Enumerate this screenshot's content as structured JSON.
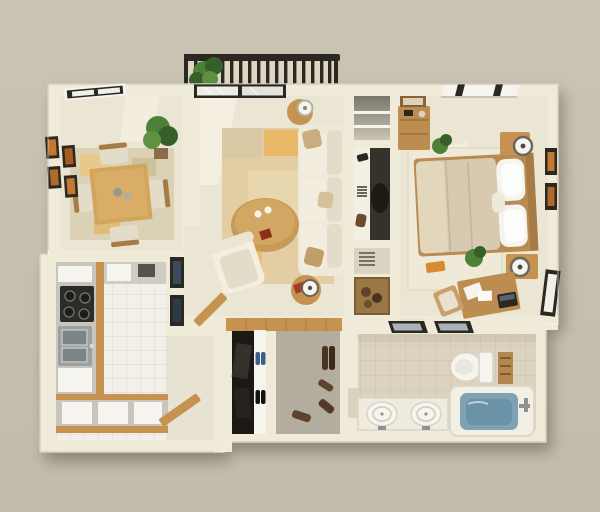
{
  "palette": {
    "bg": "#cbc4b4",
    "bgBottom": "#c2bbaa",
    "wall": "#f0ead8",
    "wallShade": "#dcd6c2",
    "wallEdge": "#b9b3a0",
    "carpet": "#ebe5d4",
    "carpetLight": "#f6f1e2",
    "wood": "#c5924f",
    "woodDark": "#a87a45",
    "woodLight": "#d2a55c",
    "dark": "#2b2723",
    "white": "#f6f4ee",
    "sofa": "#efe9da",
    "cushion": "#e3dcc9",
    "pillowTan": "#c9ad7e",
    "rugTan": "#e3cda2",
    "rugOrange": "#e9b869",
    "rugDining": "#dbd1b4",
    "bedDuvet": "#d8cab0",
    "steel": "#9ba1a1",
    "tileWhite": "#f2f0e9",
    "tileGrout": "#e3e0d5",
    "bathTile": "#dbd3bf",
    "bathGrout": "#cfc6b2",
    "grayFloor": "#b3ada0",
    "closetDark": "#1c1915",
    "water": "#7fa3b5",
    "waterDeep": "#6a93a7",
    "green": "#4f8039",
    "greenDark": "#36602a",
    "artOrange": "#c47a2e",
    "shoeBlue": "#3a5f8a",
    "shoeBrown": "#54391f",
    "counter": "#c8c5bc",
    "entryFloor": "#e8e2d2"
  },
  "scene": {
    "type": "3d-floor-plan-render",
    "rooms": [
      {
        "name": "balcony",
        "items": [
          "railing",
          "potted-plant"
        ]
      },
      {
        "name": "dining-room",
        "items": [
          "dining-table",
          "four-chairs",
          "area-rug",
          "wall-art-grid-2x2",
          "window",
          "potted-plant"
        ]
      },
      {
        "name": "living-room",
        "items": [
          "sofa",
          "armchair",
          "oval-coffee-table",
          "patterned-rug",
          "two-side-tables",
          "two-lamps",
          "sliding-glass-door",
          "partition-art-frames"
        ]
      },
      {
        "name": "storage-nook",
        "items": [
          "shelf-cabinet",
          "desk-shelf",
          "office-chair",
          "vent-cubby",
          "storage-basket"
        ]
      },
      {
        "name": "bedroom",
        "items": [
          "double-bed",
          "white-pillows",
          "two-nightstands",
          "two-lamps",
          "dresser",
          "window",
          "wall-art-frames",
          "desk",
          "desk-chair",
          "laptop",
          "plants",
          "rug"
        ]
      },
      {
        "name": "kitchen",
        "items": [
          "l-shaped-counter",
          "cooktop",
          "double-sink",
          "white-cabinets",
          "tile-floor",
          "wood-trim",
          "entry-door"
        ]
      },
      {
        "name": "hallway",
        "items": [
          "wood-floor",
          "door-leaf"
        ]
      },
      {
        "name": "closet",
        "items": [
          "hanging-clothes",
          "blue-shoes",
          "black-shoes"
        ]
      },
      {
        "name": "walk-in-closet",
        "items": [
          "gray-floor",
          "brown-shoes"
        ]
      },
      {
        "name": "bathroom",
        "items": [
          "double-sink-vanity",
          "toilet",
          "bathtub-with-water",
          "towel-shelf",
          "two-mirrors",
          "tile-floor"
        ]
      }
    ]
  }
}
